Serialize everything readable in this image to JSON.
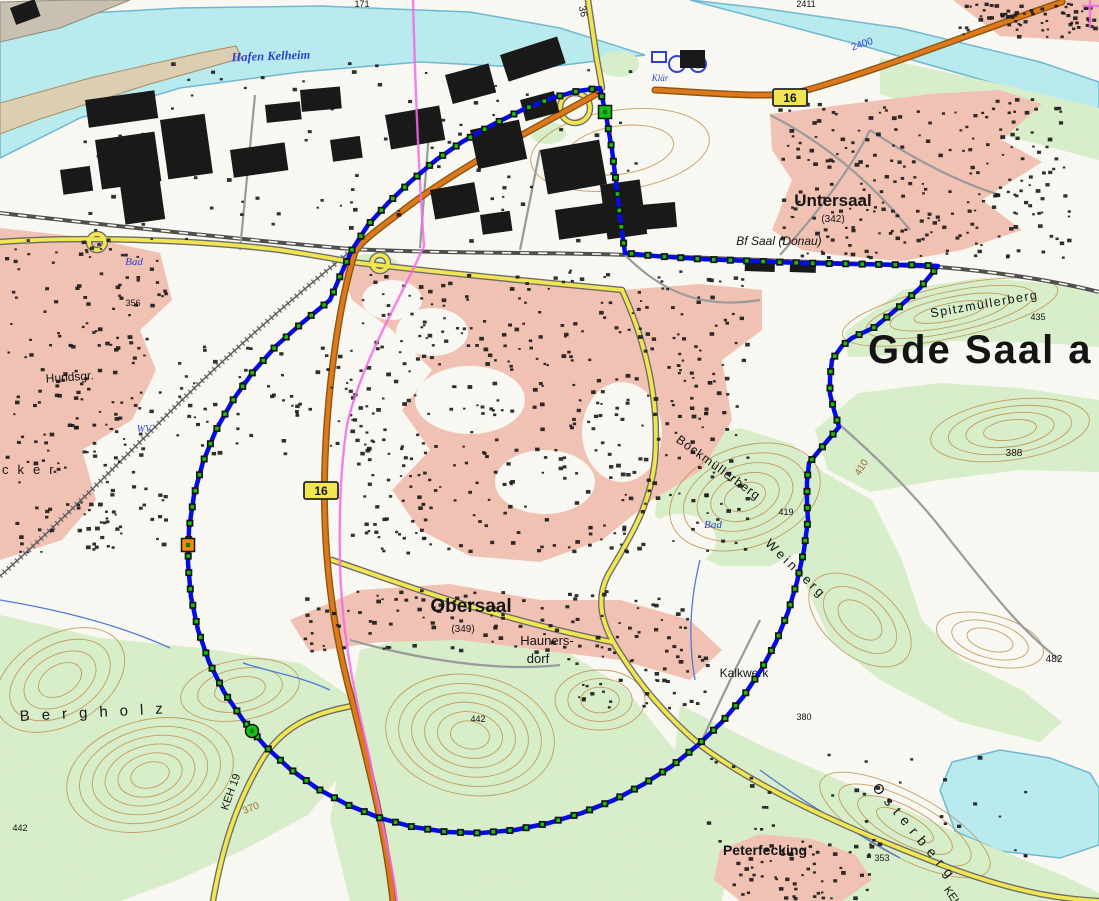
{
  "map_title": "Topographic map - Saal an der Donau region with circular measurement polygon",
  "colors": {
    "background": "#fbfaf4",
    "water": "#b9ecf0",
    "water_outline": "#6fb9d2",
    "forest": "#d9f0cb",
    "residential": "#f3c3b4",
    "building": "#161616",
    "road_orange": "#e07818",
    "road_orange_casing": "#8a5510",
    "road_yellow": "#f4e84e",
    "road_casing": "#6b6b6b",
    "road_minor": "#9a9a9a",
    "railway": "#4d4d4d",
    "contour": "#bd8e4a",
    "boundary_line": "#0008e8",
    "vertex_fill": "#12c112",
    "vertex_border": "#101010",
    "selected_vertex": "#ff8a00",
    "admin_boundary": "#f768e8",
    "label_blue": "#2b3fd0",
    "label_brown": "#a06a28",
    "label_black": "#111111",
    "shield_fill": "#f4e84e"
  },
  "road_shields": [
    {
      "label": "16",
      "x": 773,
      "y": 89
    },
    {
      "label": "16",
      "x": 304,
      "y": 482
    }
  ],
  "boundary": {
    "marker_spacing": 16.5,
    "points": [
      [
        352,
        250
      ],
      [
        368,
        225
      ],
      [
        388,
        203
      ],
      [
        410,
        182
      ],
      [
        436,
        160
      ],
      [
        462,
        142
      ],
      [
        492,
        125
      ],
      [
        522,
        110
      ],
      [
        552,
        98
      ],
      [
        578,
        91
      ],
      [
        600,
        88
      ],
      [
        606,
        115
      ],
      [
        612,
        150
      ],
      [
        617,
        190
      ],
      [
        621,
        225
      ],
      [
        625,
        253
      ],
      [
        655,
        256
      ],
      [
        700,
        259
      ],
      [
        750,
        261
      ],
      [
        800,
        263
      ],
      [
        855,
        264
      ],
      [
        915,
        265
      ],
      [
        938,
        266
      ],
      [
        920,
        288
      ],
      [
        898,
        308
      ],
      [
        875,
        327
      ],
      [
        852,
        338
      ],
      [
        842,
        346
      ],
      [
        832,
        360
      ],
      [
        830,
        378
      ],
      [
        830,
        394
      ],
      [
        834,
        410
      ],
      [
        839,
        427
      ],
      [
        823,
        446
      ],
      [
        809,
        463
      ],
      [
        807,
        482
      ],
      [
        807,
        503
      ],
      [
        808,
        520
      ],
      [
        804,
        550
      ],
      [
        797,
        582
      ],
      [
        788,
        612
      ],
      [
        776,
        642
      ],
      [
        761,
        670
      ],
      [
        743,
        697
      ],
      [
        722,
        722
      ],
      [
        698,
        745
      ],
      [
        672,
        766
      ],
      [
        644,
        784
      ],
      [
        614,
        800
      ],
      [
        582,
        813
      ],
      [
        549,
        823
      ],
      [
        515,
        830
      ],
      [
        481,
        833
      ],
      [
        447,
        832
      ],
      [
        413,
        827
      ],
      [
        380,
        818
      ],
      [
        348,
        805
      ],
      [
        318,
        789
      ],
      [
        290,
        769
      ],
      [
        265,
        746
      ],
      [
        243,
        720
      ],
      [
        224,
        692
      ],
      [
        209,
        662
      ],
      [
        198,
        630
      ],
      [
        191,
        597
      ],
      [
        188,
        563
      ],
      [
        189,
        529
      ],
      [
        194,
        495
      ],
      [
        203,
        462
      ],
      [
        216,
        430
      ],
      [
        233,
        400
      ],
      [
        253,
        372
      ],
      [
        276,
        346
      ],
      [
        302,
        323
      ],
      [
        330,
        300
      ],
      [
        341,
        274
      ],
      [
        352,
        250
      ]
    ],
    "selected_markers": [
      {
        "x": 188,
        "y": 545,
        "shape": "square",
        "color": "selected",
        "name": "selected-vertex-west"
      },
      {
        "x": 605,
        "y": 112,
        "shape": "square",
        "color": "green",
        "name": "highlighted-vertex-junction"
      },
      {
        "x": 252,
        "y": 731,
        "shape": "round",
        "color": "green",
        "name": "highlighted-vertex-southwest"
      }
    ]
  },
  "map_labels": [
    {
      "name": "hafen-kelheim",
      "text": "Hafen Kelheim",
      "x": 271,
      "y": 60,
      "size": 12.5,
      "color": "blue",
      "rot": -2,
      "bold": true,
      "italic": true,
      "serif": true
    },
    {
      "name": "klaer",
      "text": "Klär",
      "x": 660,
      "y": 81,
      "size": 9,
      "color": "blue",
      "italic": true,
      "serif": true
    },
    {
      "name": "road-36",
      "text": "36",
      "x": 580,
      "y": 12,
      "size": 10,
      "rot": 78
    },
    {
      "name": "num-171",
      "text": "171",
      "x": 362,
      "y": 7,
      "size": 9
    },
    {
      "name": "num-2411",
      "text": "2411",
      "x": 806,
      "y": 7,
      "size": 9
    },
    {
      "name": "num-2400",
      "text": "2400",
      "x": 863,
      "y": 47,
      "size": 10,
      "color": "blue",
      "rot": -18
    },
    {
      "name": "untersaal",
      "text": "Untersaal",
      "x": 833,
      "y": 206,
      "size": 17,
      "bold": true
    },
    {
      "name": "untersaal-elevation",
      "text": "(342)",
      "x": 833,
      "y": 222,
      "size": 10
    },
    {
      "name": "bf-saal-donau",
      "text": "Bf Saal (Donau)",
      "x": 779,
      "y": 245,
      "size": 12,
      "italic": true
    },
    {
      "name": "gde-saal",
      "text": "Gde Saal a",
      "x": 868,
      "y": 363,
      "size": 40,
      "bold": true,
      "anchor": "start",
      "spacing": 2
    },
    {
      "name": "spitzmuellerberg",
      "text": "Spitzmüllerberg",
      "x": 985,
      "y": 308,
      "size": 12.5,
      "rot": -10,
      "spacing": 1.5
    },
    {
      "name": "num-435",
      "text": "435",
      "x": 1038,
      "y": 320,
      "size": 9
    },
    {
      "name": "bad-west",
      "text": "Bad",
      "x": 134,
      "y": 265,
      "size": 11,
      "color": "blue",
      "italic": true,
      "serif": true
    },
    {
      "name": "num-356",
      "text": "356",
      "x": 133,
      "y": 306,
      "size": 9
    },
    {
      "name": "hundsgr",
      "text": "Hundsgr.",
      "x": 70,
      "y": 381,
      "size": 12,
      "rot": -4
    },
    {
      "name": "wv",
      "text": "WV",
      "x": 144,
      "y": 432,
      "size": 10,
      "color": "blue",
      "italic": true,
      "serif": true
    },
    {
      "name": "aecker",
      "text": "cker",
      "x": 2,
      "y": 474,
      "size": 13,
      "anchor": "start",
      "spacing": 9
    },
    {
      "name": "bockmuellerberg",
      "text": "Bockmüllerberg",
      "x": 716,
      "y": 471,
      "size": 12.5,
      "rot": 36,
      "spacing": 1
    },
    {
      "name": "num-419",
      "text": "419",
      "x": 786,
      "y": 515,
      "size": 9
    },
    {
      "name": "num-410",
      "text": "410",
      "x": 864,
      "y": 469,
      "size": 10,
      "color": "brown",
      "rot": -58
    },
    {
      "name": "num-388",
      "text": "388",
      "x": 1014,
      "y": 456,
      "size": 10
    },
    {
      "name": "bad-east",
      "text": "Bad",
      "x": 713,
      "y": 528,
      "size": 11,
      "color": "blue",
      "italic": true,
      "serif": true
    },
    {
      "name": "weinberg",
      "text": "Weinberg",
      "x": 793,
      "y": 572,
      "size": 13,
      "rot": 44,
      "spacing": 3
    },
    {
      "name": "obersaal",
      "text": "Obersaal",
      "x": 471,
      "y": 612,
      "size": 19,
      "bold": true
    },
    {
      "name": "obersaal-elevation",
      "text": "(349)",
      "x": 463,
      "y": 632,
      "size": 10
    },
    {
      "name": "haunersdorf-1",
      "text": "Hauners-",
      "x": 547,
      "y": 645,
      "size": 13
    },
    {
      "name": "haunersdorf-2",
      "text": "dorf",
      "x": 538,
      "y": 663,
      "size": 13
    },
    {
      "name": "num-442-center",
      "text": "442",
      "x": 478,
      "y": 722,
      "size": 9
    },
    {
      "name": "kalkwerk",
      "text": "Kalkwerk",
      "x": 744,
      "y": 677,
      "size": 12
    },
    {
      "name": "num-380",
      "text": "380",
      "x": 804,
      "y": 720,
      "size": 9
    },
    {
      "name": "num-482",
      "text": "482",
      "x": 1054,
      "y": 662,
      "size": 10
    },
    {
      "name": "bergholz",
      "text": "Bergholz",
      "x": 20,
      "y": 721,
      "size": 15,
      "anchor": "start",
      "spacing": 12,
      "rot": -3
    },
    {
      "name": "keh-19",
      "text": "KEH 19",
      "x": 234,
      "y": 793,
      "size": 11,
      "rot": -70
    },
    {
      "name": "num-370",
      "text": "370",
      "x": 252,
      "y": 811,
      "size": 10,
      "color": "brown",
      "rot": -22
    },
    {
      "name": "num-442-west",
      "text": "442",
      "x": 20,
      "y": 831,
      "size": 9
    },
    {
      "name": "peterfecking",
      "text": "Peterfecking",
      "x": 765,
      "y": 855,
      "size": 14,
      "bold": true
    },
    {
      "name": "num-353",
      "text": "353",
      "x": 882,
      "y": 861,
      "size": 9
    },
    {
      "name": "osterberg",
      "text": "Osterberg",
      "x": 912,
      "y": 836,
      "size": 14,
      "rot": 50,
      "spacing": 7
    },
    {
      "name": "keh-bottom",
      "text": "KEH",
      "x": 950,
      "y": 899,
      "size": 11,
      "rot": 55
    },
    {
      "name": "num-9",
      "text": "9",
      "x": 494,
      "y": 219,
      "size": 8
    }
  ]
}
